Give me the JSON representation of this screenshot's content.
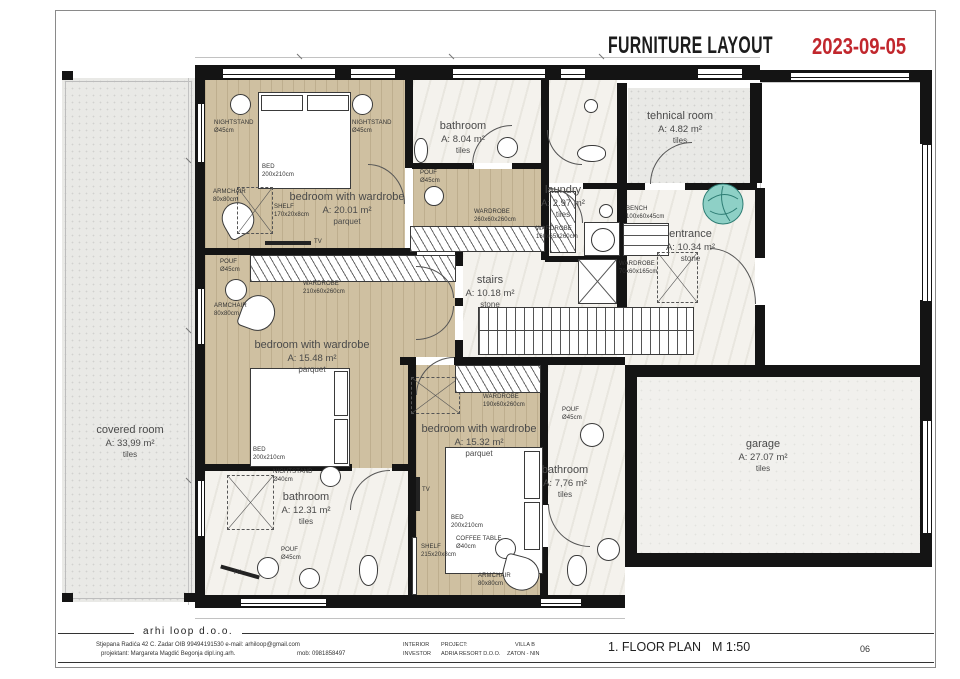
{
  "header": {
    "title": "FURNITURE LAYOUT",
    "date": "2023-09-05"
  },
  "colors": {
    "accent_red": "#c1272d",
    "wall_black": "#141414",
    "wood_floor": "#cfc0a1",
    "stone_floor": "#f4f2ed"
  },
  "rooms": [
    {
      "name": "covered room",
      "area": "A: 33,99 m²",
      "floor": "tiles"
    },
    {
      "name": "bedroom with wardrobe",
      "area": "A: 20.01 m²",
      "floor": "parquet"
    },
    {
      "name": "bathroom",
      "area": "A: 8.04 m²",
      "floor": "tiles"
    },
    {
      "name": "laundry",
      "area": "A: 2.97 m²",
      "floor": "tiles"
    },
    {
      "name": "tehnical room",
      "area": "A: 4.82 m²",
      "floor": "tiles"
    },
    {
      "name": "entrance",
      "area": "A: 10.34 m²",
      "floor": "stone"
    },
    {
      "name": "stairs",
      "area": "A: 10.18 m²",
      "floor": "stone"
    },
    {
      "name": "bedroom with wardrobe",
      "area": "A: 15.48 m²",
      "floor": "parquet"
    },
    {
      "name": "bathroom",
      "area": "A: 12.31 m²",
      "floor": "tiles"
    },
    {
      "name": "bedroom with wardrobe",
      "area": "A: 15.32 m²",
      "floor": "parquet"
    },
    {
      "name": "bathroom",
      "area": "A: 7,76 m²",
      "floor": "tiles"
    },
    {
      "name": "garage",
      "area": "A: 27.07 m²",
      "floor": "tiles"
    }
  ],
  "furniture": [
    "NIGHTSTAND\nØ45cm",
    "NIGHTSTAND\nØ45cm",
    "BED\n200x210cm",
    "ARMCHAIR\n80x80cm",
    "SHELF\n170x20x8cm",
    "TV",
    "POUF\nØ45cm",
    "WARDROBE\n260x60x260cm",
    "WARDROBE\n160x65x260cm",
    "BENCH\n100x60x45cm",
    "WARDROBE\n70x60x165cm",
    "POUF\nØ45cm",
    "WARDROBE\n210x60x260cm",
    "ARMCHAIR\n80x80cm",
    "BED\n200x210cm",
    "NIGHTSTAND\nØ40cm",
    "POUF\nØ45cm",
    "TV",
    "WARDROBE\n190x60x260cm",
    "BED\n200x210cm",
    "POUF\nØ45cm",
    "SHELF\n215x20x8cm",
    "COFFEE TABLE\nØ40cm",
    "ARMCHAIR\n80x80cm",
    "TV"
  ],
  "footer": {
    "company": "arhi loop   d.o.o.",
    "address": "Stjepana Radića 42 C. Zadar    OIB 99494191530    e-mail: arhiloop@gmail.com",
    "designer": "projektant: Margareta Magdić Begonja  dipl.ing.arh.",
    "mobile": "mob: 0981858497",
    "interior_label": "INTERIOR",
    "project_label": "PROJECT:",
    "project_value": "VILLA  B",
    "investor_label": "INVESTOR",
    "investor_value": "ADRIA RESORT D.O.O.",
    "location": "ZATON - NIN",
    "plan_title": "1. FLOOR PLAN",
    "scale": "M 1:50",
    "sheet_number": "06"
  }
}
